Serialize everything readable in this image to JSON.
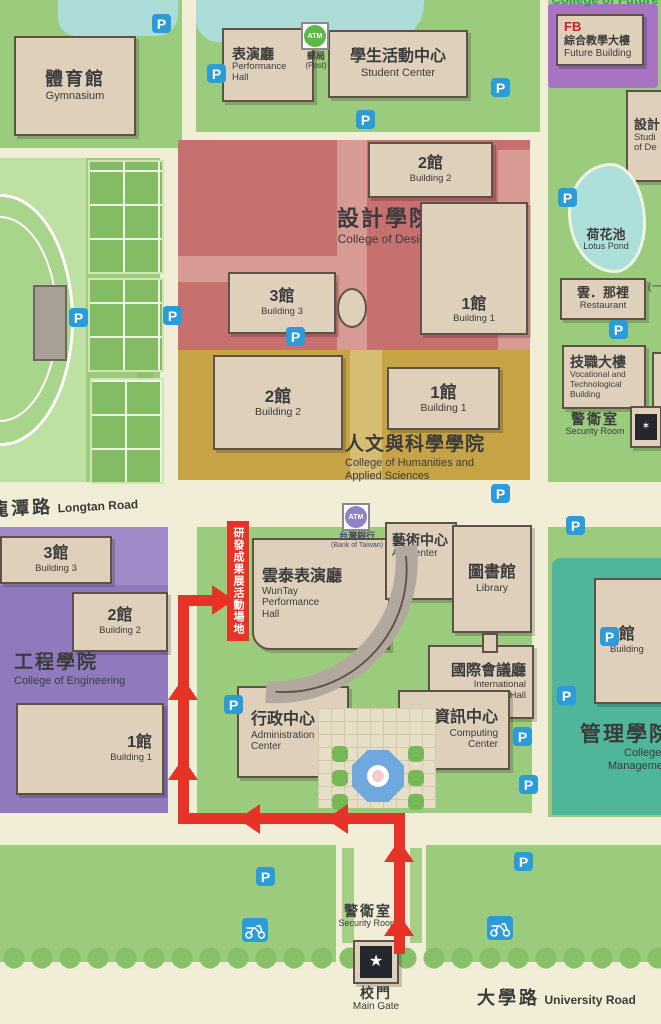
{
  "roads": {
    "longtan": {
      "zh": "龍潭路",
      "en": "Longtan Road"
    },
    "university": {
      "zh": "大學路",
      "en": "University Road"
    }
  },
  "zones": {
    "design": {
      "zh": "設計學院",
      "en": "College of Design"
    },
    "humanities": {
      "zh": "人文與科學學院",
      "en1": "College of Humanities and",
      "en2": "Applied Sciences"
    },
    "engineering": {
      "zh": "工程學院",
      "en": "College of Engineering"
    },
    "management": {
      "zh": "管理學院",
      "en1": "College of",
      "en2": "Management"
    },
    "future": {
      "en": "College of Future"
    }
  },
  "buildings": {
    "gymnasium": {
      "zh": "體育館",
      "en": "Gymnasium"
    },
    "performance_hall": {
      "zh": "表演廳",
      "en1": "Performance",
      "en2": "Hall"
    },
    "student_center": {
      "zh": "學生活動中心",
      "en": "Student Center"
    },
    "post_office": {
      "atm": "ATM",
      "zh": "郵局",
      "en": "(Post)"
    },
    "future_building": {
      "code": "FB",
      "zh": "綜合教學大樓",
      "en": "Future Building"
    },
    "design_studios": {
      "zh": "設計",
      "en1": "Studi",
      "en2": "of De"
    },
    "lotus_pond": {
      "zh": "荷花池",
      "en": "Lotus Pond"
    },
    "restaurant": {
      "zh": "雲．那裡",
      "en": "Restaurant",
      "aside": "(一碗"
    },
    "vocational": {
      "zh": "技職大樓",
      "en1": "Vocational and",
      "en2": "Technological",
      "en3": "Building"
    },
    "security_room_east": {
      "zh": "警衛室",
      "en": "Security Room"
    },
    "design_b1": {
      "zh": "1館",
      "en": "Building 1"
    },
    "design_b2": {
      "zh": "2館",
      "en": "Building 2"
    },
    "design_b3": {
      "zh": "3館",
      "en": "Building 3"
    },
    "hum_b1": {
      "zh": "1館",
      "en": "Building 1"
    },
    "hum_b2": {
      "zh": "2館",
      "en": "Building 2"
    },
    "eng_b1": {
      "zh": "1館",
      "en": "Building 1"
    },
    "eng_b2": {
      "zh": "2館",
      "en": "Building 2"
    },
    "eng_b3": {
      "zh": "3館",
      "en": "Building 3"
    },
    "mgmt_b1": {
      "zh": "1館",
      "en": "Building"
    },
    "wuntay": {
      "zh": "雲泰表演廳",
      "en1": "WunTay",
      "en2": "Performance",
      "en3": "Hall"
    },
    "bank_atm": {
      "atm": "ATM",
      "zh": "台灣銀行",
      "en": "(Bank of Taiwan)"
    },
    "art_center": {
      "zh": "藝術中心",
      "en": "Art Center"
    },
    "library": {
      "zh": "圖書館",
      "en": "Library"
    },
    "conference_hall": {
      "zh": "國際會議廳",
      "en1": "International",
      "en2": "Conference Hall"
    },
    "admin_center": {
      "zh": "行政中心",
      "en1": "Administration",
      "en2": "Center"
    },
    "computing_center": {
      "zh": "資訊中心",
      "en1": "Computing",
      "en2": "Center"
    },
    "security_room_gate": {
      "zh": "警衛室",
      "en": "Security Room"
    },
    "main_gate": {
      "zh": "校門",
      "en": "Main Gate"
    }
  },
  "event_route": {
    "label": "研發成果展活動場地",
    "color": "#E63227"
  },
  "parking": {
    "label": "P",
    "color": "#2B9CD8",
    "positions": [
      [
        152,
        14
      ],
      [
        207,
        64
      ],
      [
        356,
        110
      ],
      [
        491,
        78
      ],
      [
        558,
        188
      ],
      [
        69,
        308
      ],
      [
        163,
        306
      ],
      [
        286,
        327
      ],
      [
        609,
        320
      ],
      [
        491,
        484
      ],
      [
        566,
        516
      ],
      [
        224,
        695
      ],
      [
        600,
        627
      ],
      [
        557,
        686
      ],
      [
        513,
        727
      ],
      [
        519,
        775
      ],
      [
        514,
        852
      ],
      [
        256,
        867
      ]
    ]
  },
  "motorcycle_parking": {
    "positions": [
      [
        242,
        918
      ],
      [
        487,
        916
      ]
    ]
  },
  "colors": {
    "design_zone": "#C77070",
    "humanities_zone": "#C6A345",
    "engineering_zone": "#9179BE",
    "management_zone": "#4FB69C",
    "future_zone": "#A873C2",
    "campus_green": "#9BCB7D",
    "water": "#ABDCD8",
    "building": "#DFD0BC",
    "route_red": "#E63227",
    "parking_blue": "#2B9CD8"
  }
}
